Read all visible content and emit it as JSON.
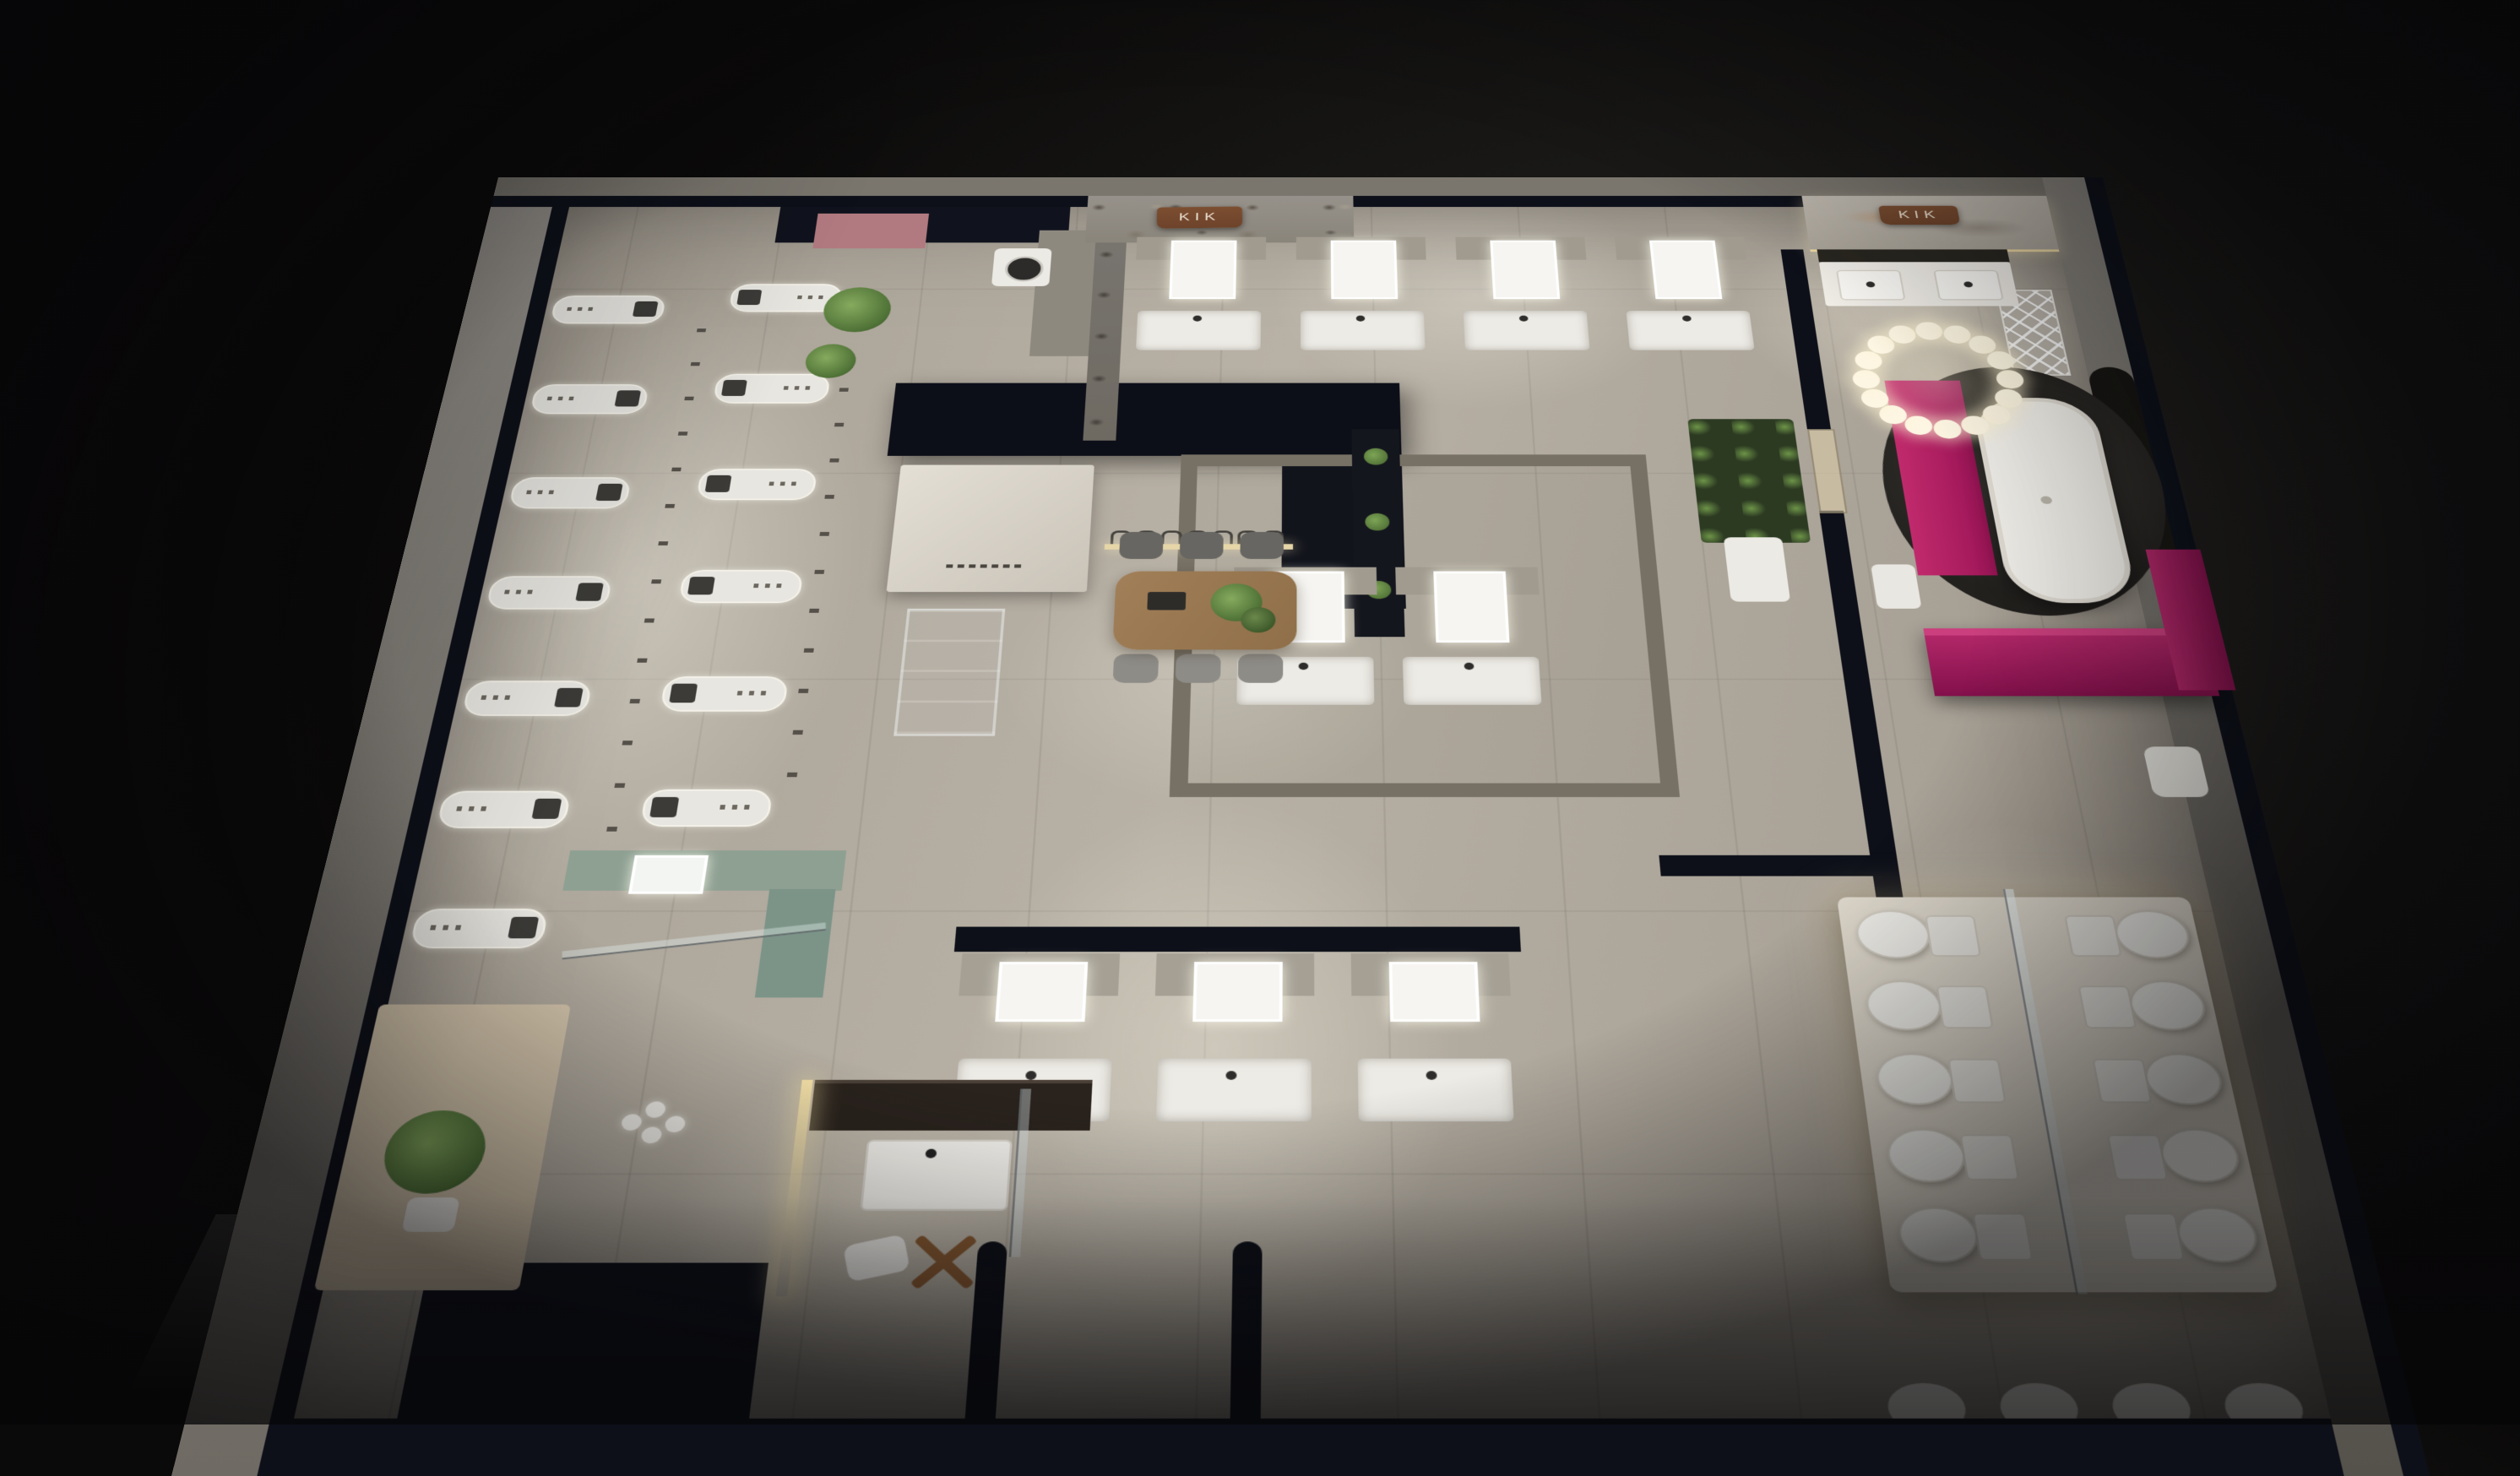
{
  "scene": {
    "description": "Night-time isometric 3D render of a KIK bathroom-fixtures showroom floor plan, viewed from above",
    "style": "dollhouse cutaway, dark surroundings, warm spot lighting"
  },
  "signs": {
    "brand": "KIK"
  },
  "palette": {
    "bg_dark": "#131211",
    "wall_navy": "#0d1019",
    "outer_gray": "#8a867f",
    "floor_base": "#a59e93",
    "stone_gray": "#8d887e",
    "accent_magenta": "#9c1557",
    "accent_pink": "#b17a80",
    "copper": "#7c4e31",
    "wood": "#a17f58",
    "plant_green": "#5a7c3e",
    "led_warm": "#eed9a2",
    "fixture_white": "#efede7",
    "sage": "#8ea092"
  },
  "fixtures": {
    "shower_row_outer": 7,
    "shower_row_inner": 6,
    "far_wall_vanities": 4,
    "room_vanities": 2,
    "aisle_vanities": 3,
    "toilet_rows": 5,
    "toilet_columns": 2,
    "front_wall_toilets": 4,
    "pendant_ring_bulbs": 16,
    "dining_chairs": 6,
    "pendant_arc_hooks": 7
  }
}
